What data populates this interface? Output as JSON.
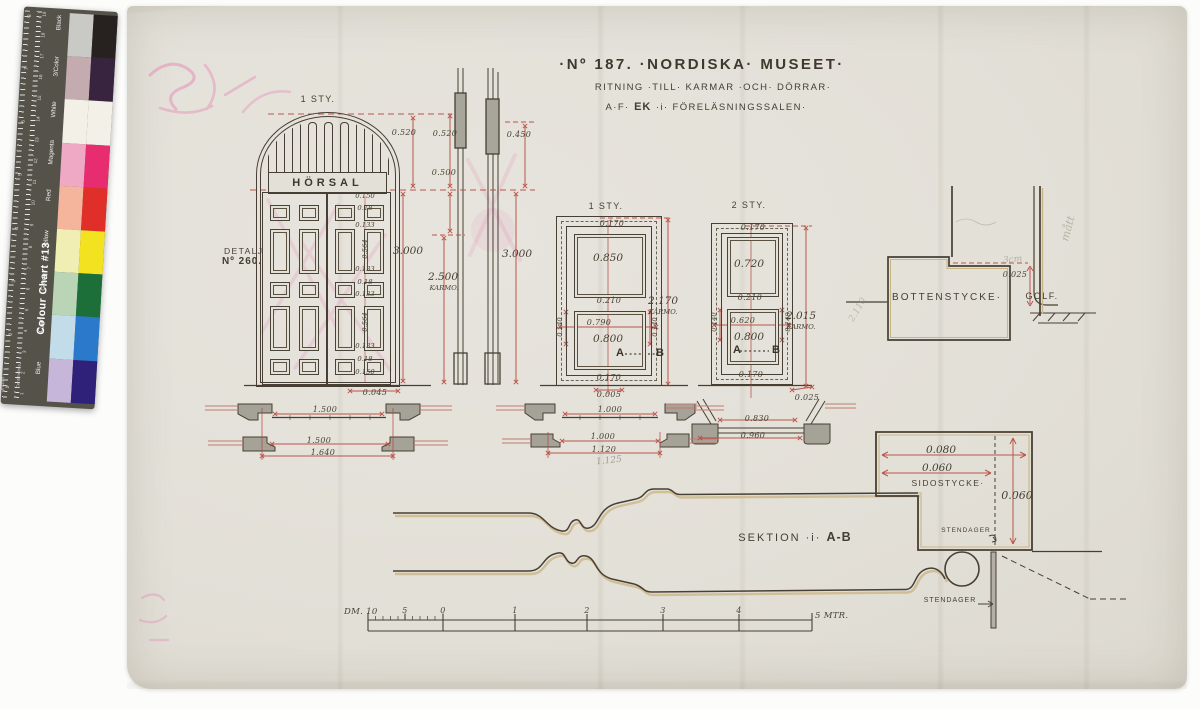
{
  "colors": {
    "ink": "#453e32",
    "dim_red": "#b5473d",
    "shadow_tan": "#c9b588",
    "paper": "#e3e0d8",
    "pencil": "#8d8779",
    "pink": "#e57fb1"
  },
  "title": {
    "line1": "·Nº 187. ·NORDISKA· MUSEET·",
    "line2": "RITNING ·TILL· KARMAR ·OCH· DÖRRAR·",
    "line3_pre": "A·F·",
    "line3_bold": "EK",
    "line3_post": "·i· FÖRELÄSNINGSSALEN·"
  },
  "elevation": {
    "count_label": "1 STY.",
    "sign": "HÖRSAL",
    "detail_line1": "DETALJ",
    "detail_line2": "Nº 260.",
    "dim_arch": "0.520",
    "dim_total": "3.000",
    "dim_bottom": "0.045",
    "col": [
      "0.150",
      "0.18",
      "0.133",
      "0.564",
      "0.133",
      "0.18",
      "0.133",
      "0.564",
      "0.133",
      "0.18",
      "0.150"
    ]
  },
  "side_section": {
    "dim_top": "0.520",
    "dim_top_right": "0.450",
    "dim_mid": "0.500",
    "dim_karm": "2.500",
    "karm_suffix": "KARMO.",
    "dim_total": "3.000"
  },
  "door1": {
    "count_label": "1 STY.",
    "dim_top": "0.170",
    "dim_upper_panel": "0.850",
    "dim_mid": "0.210",
    "dim_lower_w": "0.790",
    "dim_lower_h": "0.800",
    "dim_side_l": "0.140",
    "dim_side_r": "0.140",
    "dim_bottom": "0.170",
    "dim_floor": "0.005",
    "dim_karm": "2.170",
    "karm_suffix": "KARMO.",
    "sect_a": "A",
    "sect_b": "B"
  },
  "door2": {
    "count_label": "2 STY.",
    "dim_top": "0.170",
    "dim_upper_panel": "0.720",
    "dim_mid": "0.210",
    "dim_lower_w": "0.620",
    "dim_lower_h": "0.800",
    "dim_side_l": "0.140",
    "dim_side_r": "0.140",
    "dim_bottom": "0.170",
    "dim_floor": "0.025",
    "dim_karm": "2.015",
    "karm_suffix": "KARMO.",
    "sect_a": "A",
    "sect_b": "B",
    "pencil_note": "2.110"
  },
  "bottenstycke": {
    "label": "BOTTENSTYCKE·",
    "dim": "0.025",
    "floor_label": "GOLF.",
    "pencil_note": "3cm",
    "pencil_side": "mått"
  },
  "sidostycke": {
    "label": "SIDOSTYCKE·",
    "dim_w1": "0.080",
    "dim_w2": "0.060",
    "dim_h": "0.060",
    "post_label_1": "STENDAGER",
    "post_label_2": "STENDAGER"
  },
  "sektion": {
    "label_pre": "SEKTION ·i· ",
    "label_bold": "A-B"
  },
  "plans": {
    "left": {
      "d1": "1.500",
      "d2": "1.500",
      "d3": "1.640"
    },
    "mid": {
      "d1": "1.000",
      "d2": "1.000",
      "d3": "1.120",
      "pencil": "1.125"
    },
    "right": {
      "d1": "0.830",
      "d2": "0.960"
    }
  },
  "scale_bar": {
    "label_dm": "DM. 10",
    "ticks": [
      "5",
      "0",
      "1",
      "2",
      "3",
      "4"
    ],
    "label_m": "5 MTR."
  },
  "color_chart": {
    "title": "Colour Chart #13",
    "side_label_cm": "Centimetres",
    "side_label_in": "Inches",
    "cm_numbers_top_to_bottom": [
      "19",
      "18",
      "17",
      "16",
      "15",
      "14",
      "13",
      "12",
      "11",
      "10",
      "9",
      "8",
      "7",
      "6",
      "5",
      "4",
      "3",
      "2",
      "1"
    ],
    "inch_numbers_top_to_bottom": [
      "8",
      "7",
      "6",
      "5",
      "4",
      "3",
      "2",
      "1"
    ],
    "rows": [
      {
        "label": "Black",
        "tint": "#c9c9c5",
        "solid": "#272220"
      },
      {
        "label": "3/Color",
        "tint": "#c3abb0",
        "solid": "#38243f"
      },
      {
        "label": "White",
        "tint": "#f3f0e7",
        "solid": "#f3f0e7"
      },
      {
        "label": "Magenta",
        "tint": "#f0a9c5",
        "solid": "#e72d70"
      },
      {
        "label": "Red",
        "tint": "#f5b59d",
        "solid": "#df2f28"
      },
      {
        "label": "Yellow",
        "tint": "#f0eeb2",
        "solid": "#f2e21f"
      },
      {
        "label": "Green",
        "tint": "#bad5b5",
        "solid": "#1d6f39"
      },
      {
        "label": "Cyan",
        "tint": "#c2dde9",
        "solid": "#2a79ca"
      },
      {
        "label": "Blue",
        "tint": "#c6b6da",
        "solid": "#2f2079"
      }
    ]
  }
}
